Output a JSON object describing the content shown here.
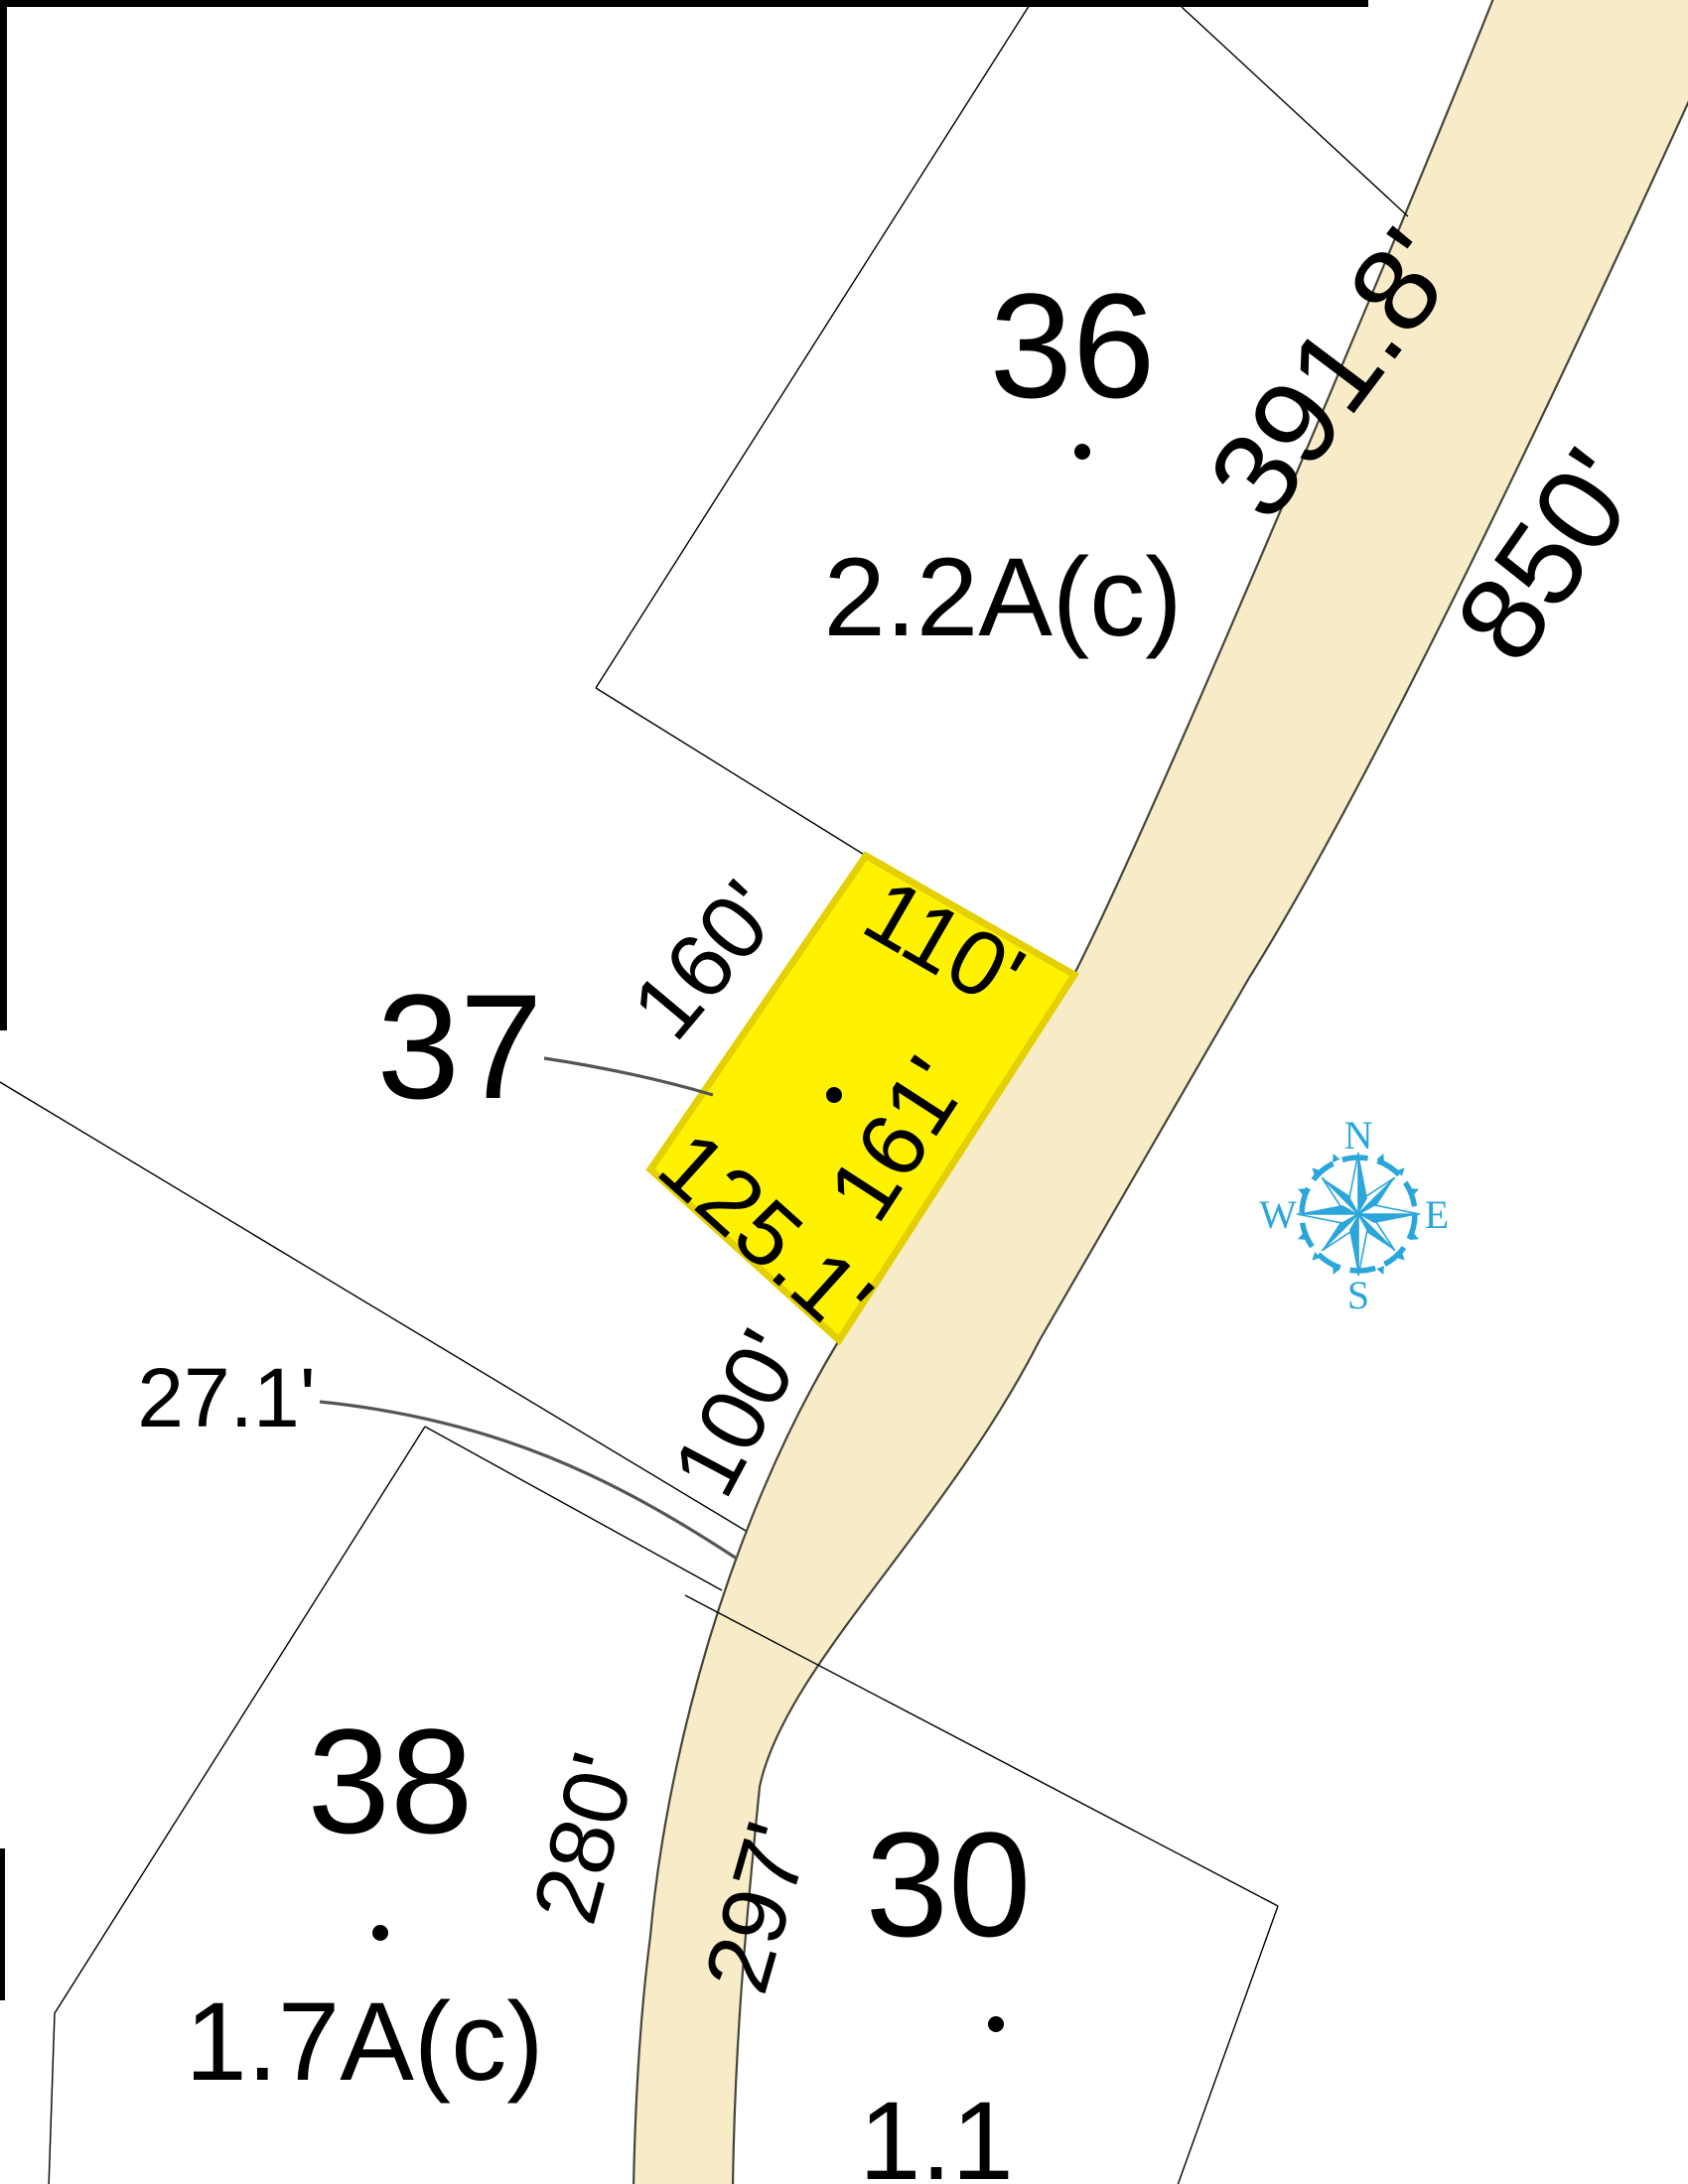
{
  "map": {
    "colors": {
      "road_fill": "#F8ECC8",
      "road_outline": "#45453a",
      "parcel_line_color": "#000000",
      "leader_color": "#555555",
      "highlight_fill": "#FFF200",
      "highlight_stroke": "#E4D000",
      "compass_color": "#2BA6DB",
      "background": "#ffffff"
    }
  },
  "parcels": {
    "lot36": {
      "label": "36",
      "area": "2.2A(c)"
    },
    "lot37": {
      "label": "37",
      "highlighted": true
    },
    "lot38": {
      "label": "38",
      "area": "1.7A(c)"
    },
    "lot30": {
      "label": "30",
      "area": "1.1"
    }
  },
  "dimensions": {
    "road_frontage_lot36": "391.8'",
    "road_far_side": "850'",
    "lot37_nw_side": "160'",
    "lot37_ne_side": "110'",
    "lot37_se_side": "161'",
    "lot37_sw_side": "125.1'",
    "frontage_below_lot37": "100'",
    "gap_between_37_38": "27.1'",
    "lot38_road_side": "280'",
    "lot30_road_side": "297'"
  },
  "compass": {
    "n": "N",
    "e": "E",
    "s": "S",
    "w": "W"
  }
}
